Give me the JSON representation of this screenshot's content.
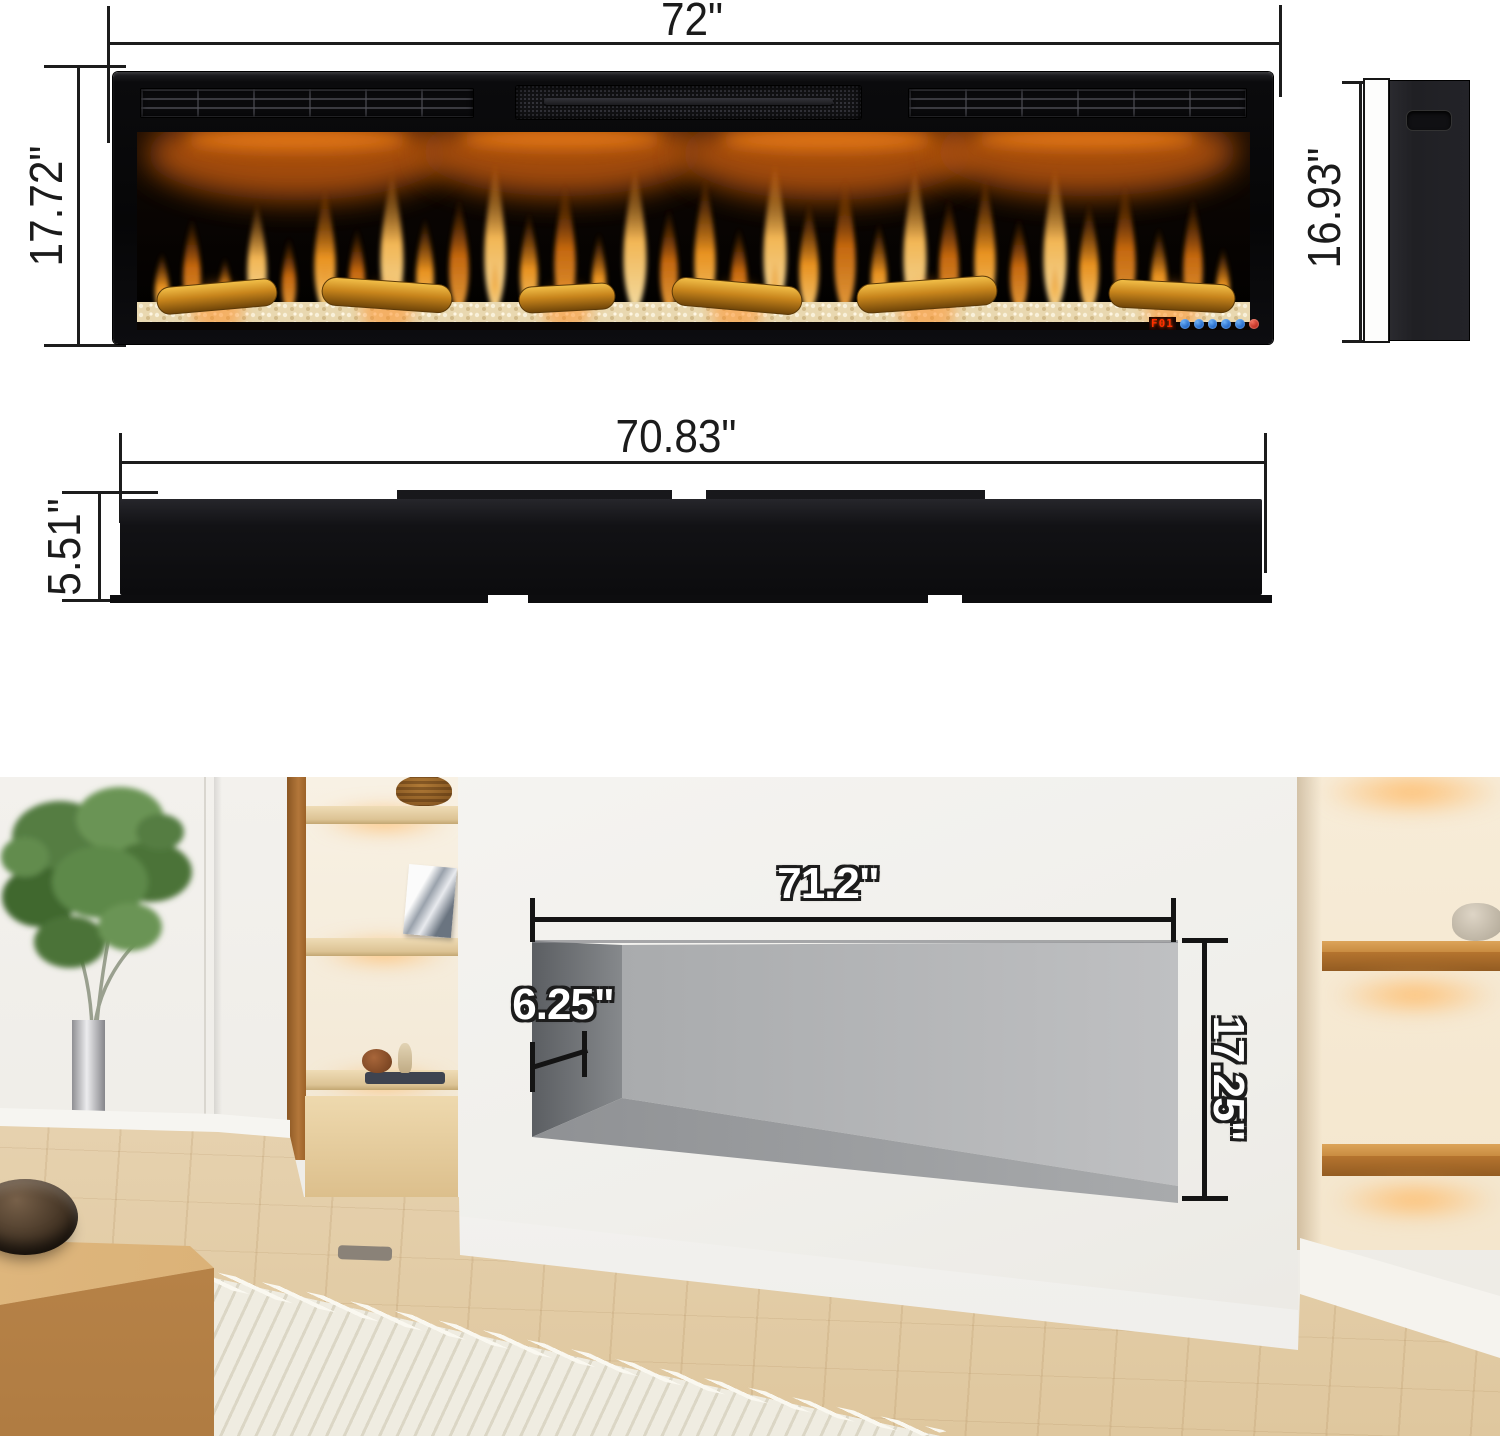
{
  "front_view": {
    "width_label": "72\"",
    "height_label": "17.72\"",
    "led_display": "F01"
  },
  "side_view": {
    "height_label": "16.93\""
  },
  "top_view": {
    "width_label": "70.83\"",
    "depth_label": "5.51\""
  },
  "installation": {
    "opening_width_label": "71.2\"",
    "recess_depth_label": "6.25\"",
    "opening_height_label": "17.25\""
  },
  "colors": {
    "dimension_line": "#1c1c1c",
    "flame_orange": "#f59a22",
    "led_red": "#ff2e00",
    "button_blue": "#2f7fe8",
    "power_red": "#bb271b"
  }
}
